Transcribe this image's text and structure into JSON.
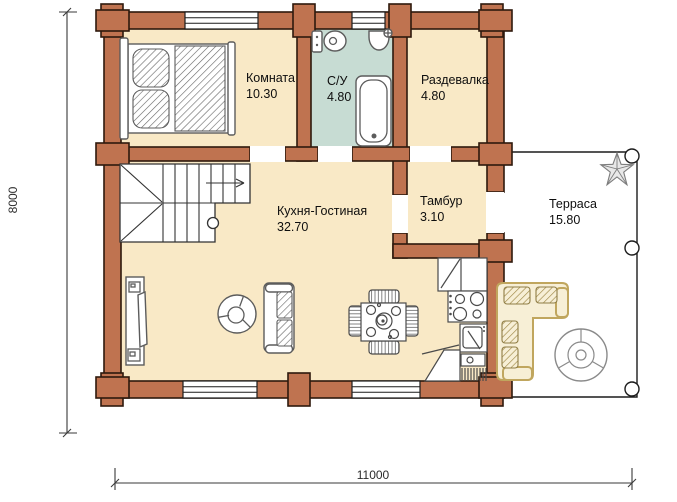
{
  "plan": {
    "rooms": [
      {
        "name": "Комната",
        "area": "10.30"
      },
      {
        "name": "С/У",
        "area": "4.80"
      },
      {
        "name": "Раздевалка",
        "area": "4.80"
      },
      {
        "name": "Кухня-Гостиная",
        "area": "32.70"
      },
      {
        "name": "Тамбур",
        "area": "3.10"
      },
      {
        "name": "Терраса",
        "area": "15.80"
      }
    ],
    "dimensions": {
      "bottom": "11000",
      "left": "8000"
    },
    "icons": [
      "bed",
      "pillow",
      "toilet",
      "washbasin",
      "bathtub",
      "stairs",
      "tv-stand",
      "armchair",
      "sofa",
      "dining-table",
      "chair",
      "kitchen-counter",
      "stove",
      "kitchen-sink",
      "corner-sofa",
      "round-table",
      "plant",
      "post"
    ],
    "colors": {
      "wall": "#bf7350",
      "outline": "#2e190d",
      "floor": "#f9e9c6",
      "bathroom": "#c7dcd3",
      "terrace": "#ffffff",
      "furniture_gray": "#5c5c5c",
      "kitchen_line": "#4a4a4a",
      "tan": "#c0a65e",
      "tan_fill": "#f7efd6"
    }
  }
}
